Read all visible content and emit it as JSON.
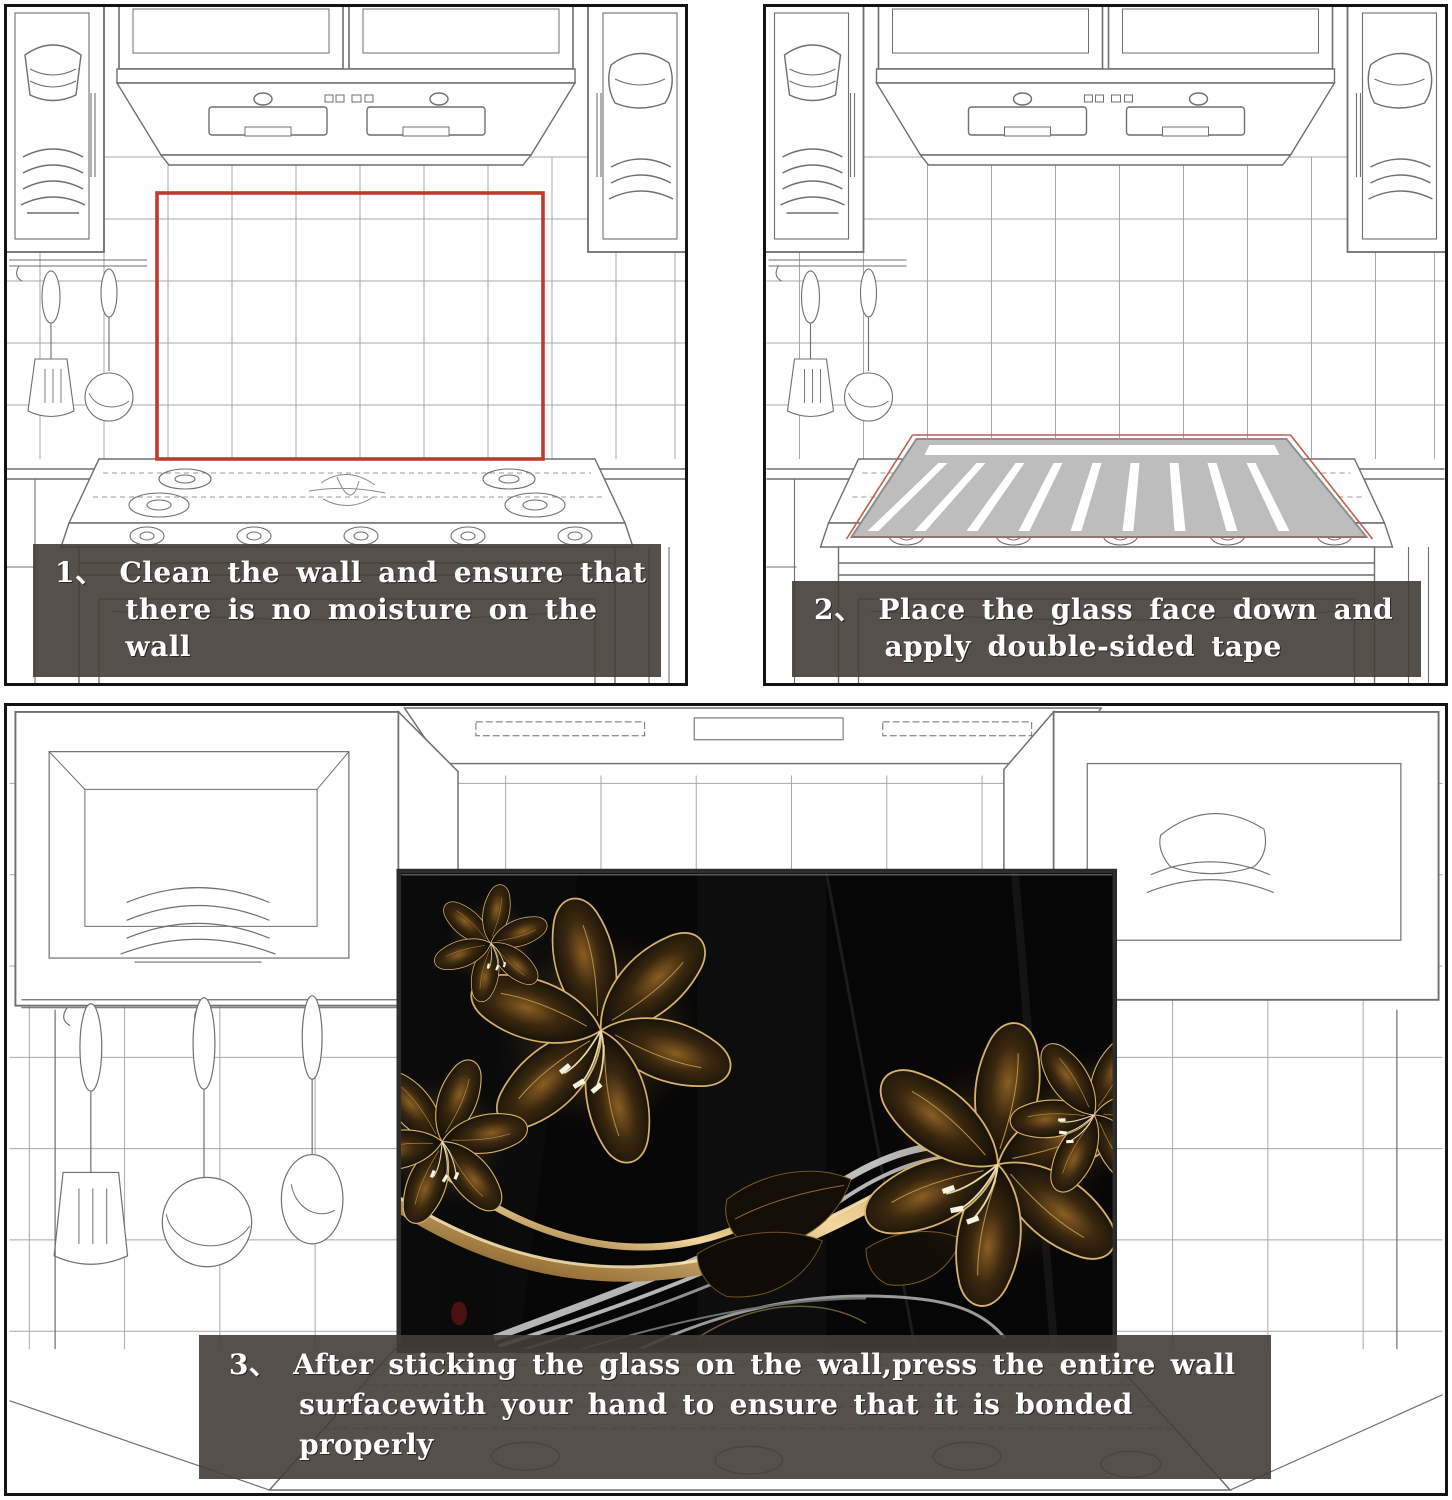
{
  "steps": [
    {
      "number": "1、",
      "lines": [
        "Clean the wall and ensure that",
        "there is no moisture on the wall"
      ]
    },
    {
      "number": "2、",
      "lines": [
        "Place the glass face down and",
        "apply double-sided tape"
      ]
    },
    {
      "number": "3、",
      "lines": [
        "After sticking the glass on the wall,press the entire wall",
        "surfacewith your hand to ensure that it is  bonded properly"
      ]
    }
  ],
  "colors": {
    "caption_background": "#423d35",
    "caption_text": "#ffffff",
    "marker_red_outline": "#c23a2c",
    "glass_face_down_gray": "#bdbdbd",
    "tape_strip_white": "#ffffff",
    "sketch_line_gray": "#6f6f6f",
    "artwork_background_black": "#060606",
    "artwork_gold": "#c89a55",
    "artwork_silver": "#c2c2c2"
  }
}
